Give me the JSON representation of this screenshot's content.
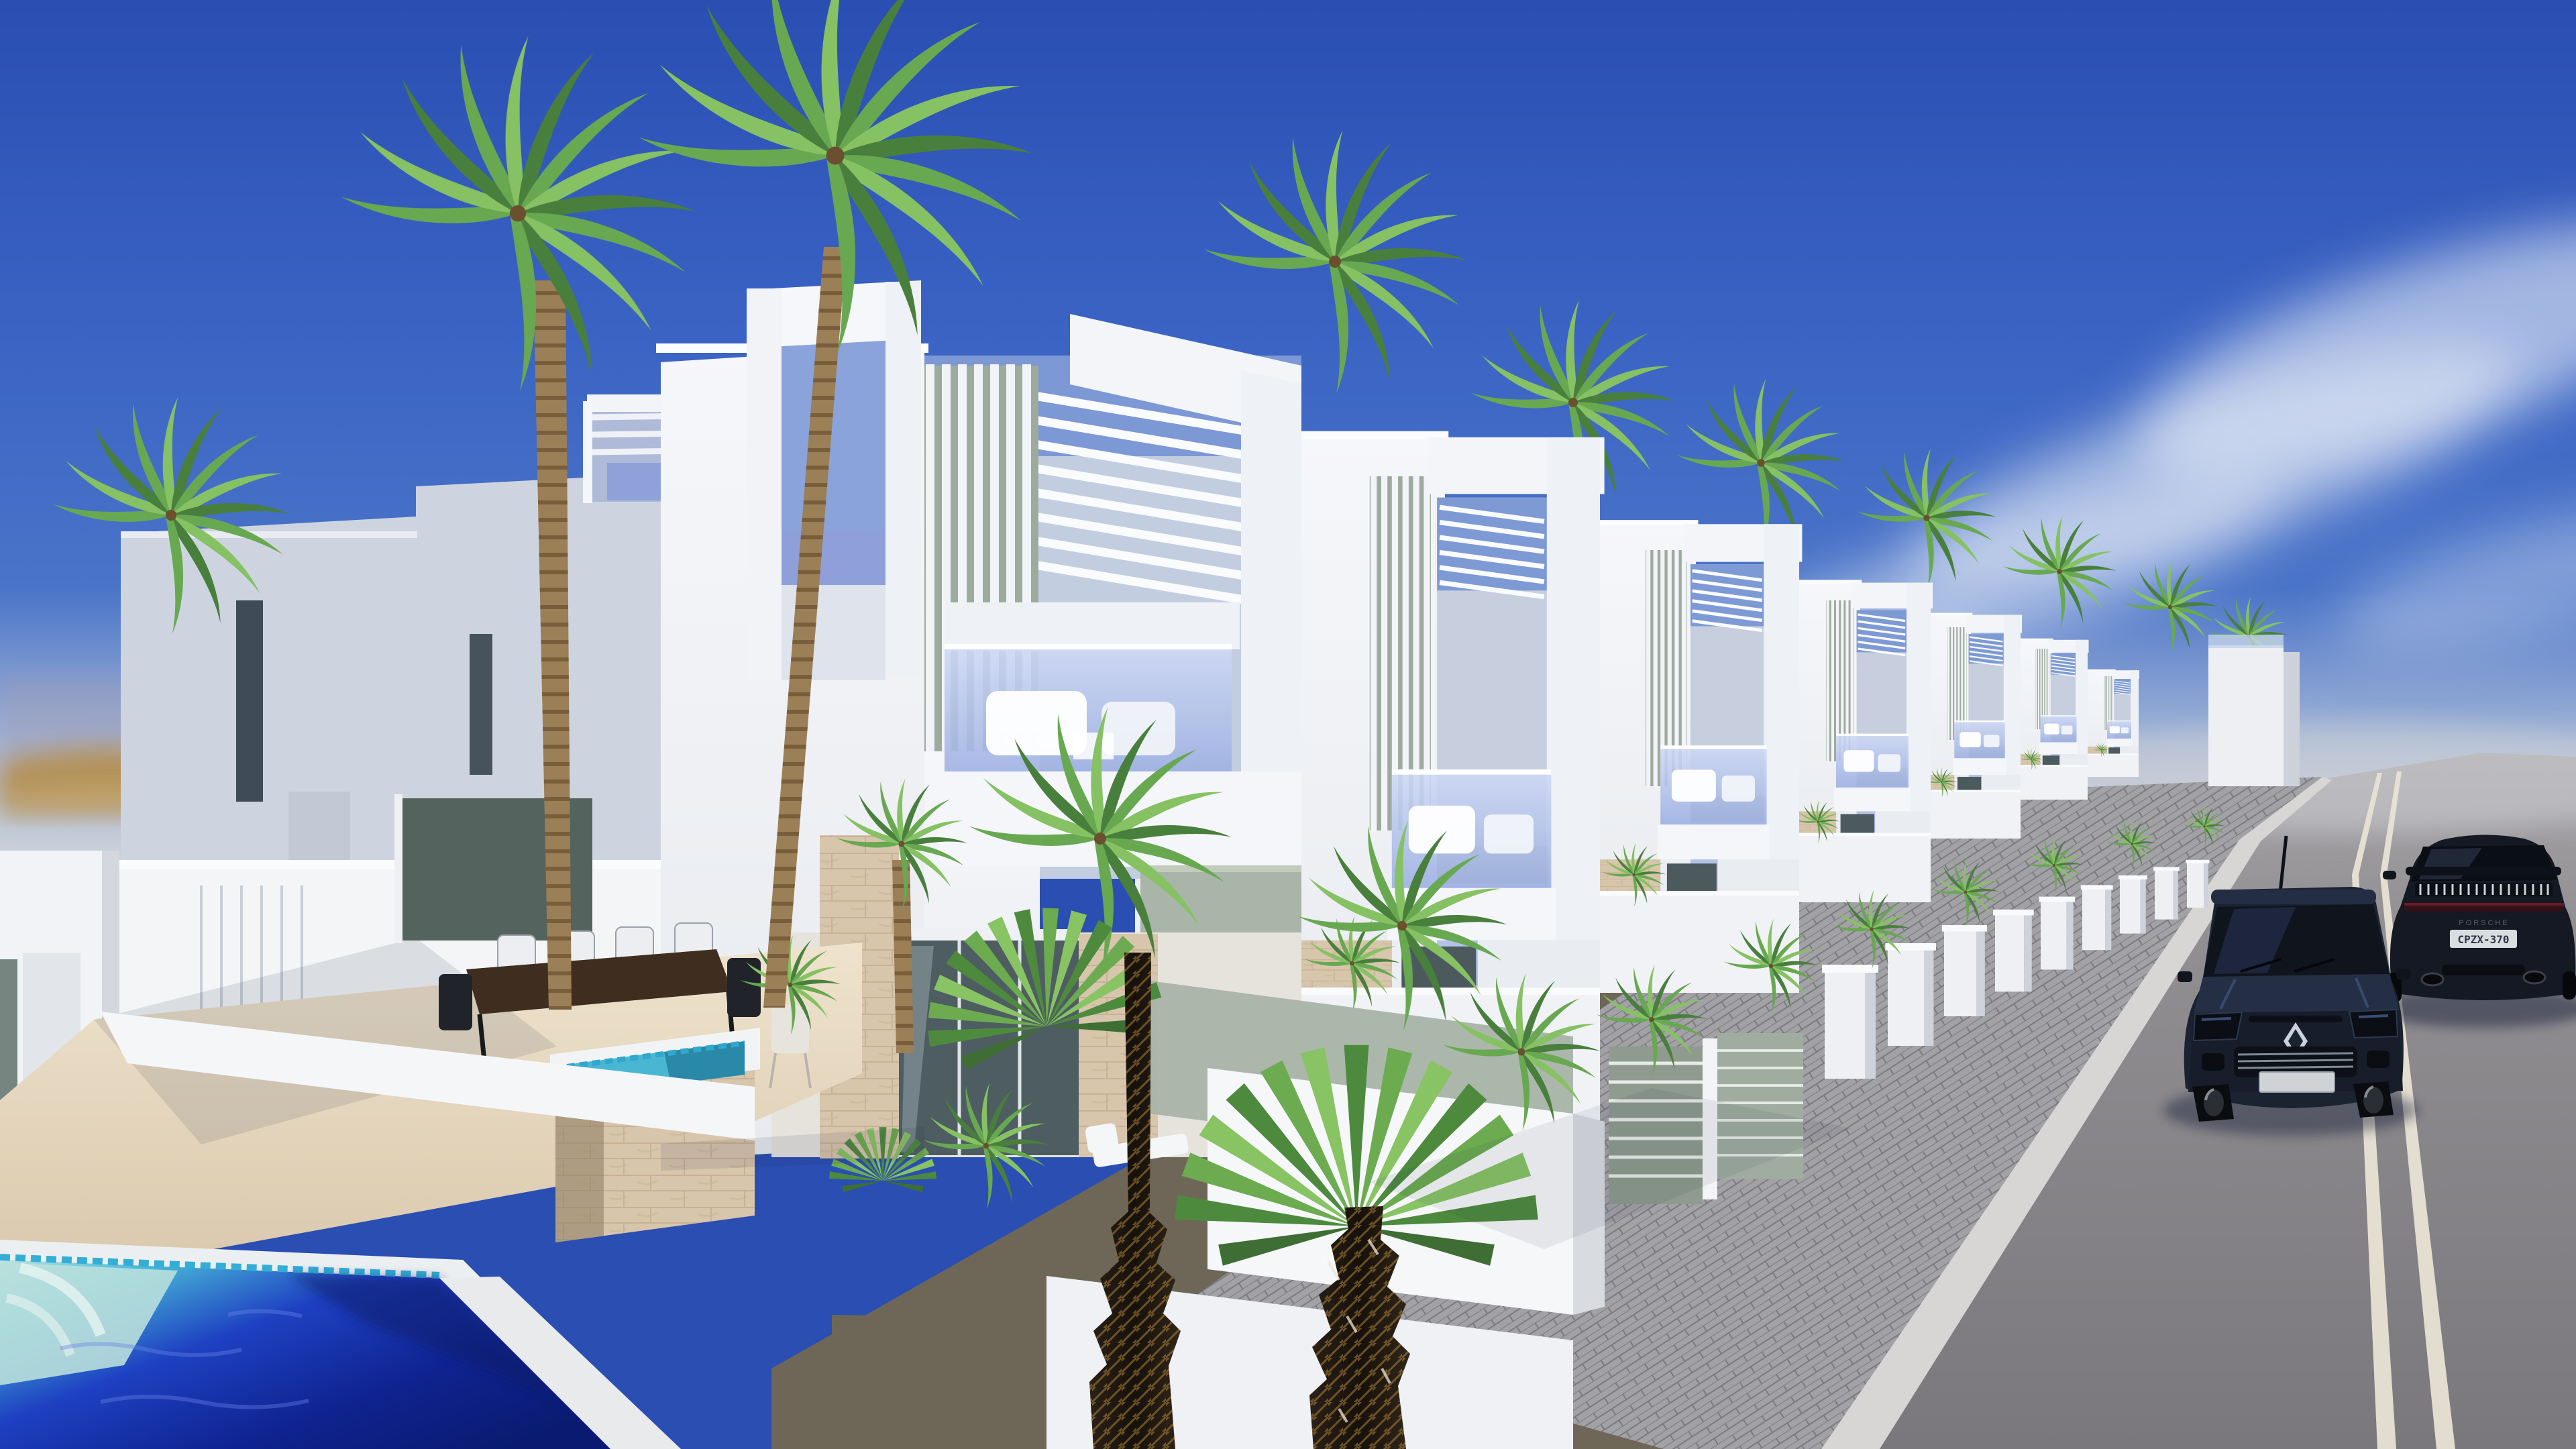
{
  "scene": {
    "type": "3d-architectural-rendering",
    "description": "Street-side view of a row of modern white two-storey villas with rooftop pergola slats, vertical louvers, glass balconies and private pools; tall palm trees, a deep blue swimming pool in the foreground, a paved sidewalk and an asphalt road with a double center line, a dark Renault hatchback and a black Porsche coupe driving uphill under a clear blue sky",
    "time_of_day": "midday",
    "weather": "sunny with thin wispy clouds",
    "setting": "coastal resort development with desert hills on the left horizon"
  },
  "counts": {
    "villas": 10,
    "palm_trees": 14,
    "cars": 2,
    "pools": 3,
    "sun_loungers": 3,
    "dining_chairs": 6
  },
  "road": {
    "surface": "asphalt",
    "marking": "double solid center line",
    "marking_color_name": "off-white",
    "sidewalk": "grey paver bricks with light concrete curb"
  },
  "vehicles": {
    "hatchback": {
      "label": "dark navy Renault hatchback, front view",
      "brand_logo": "renault-diamond-icon"
    },
    "sports_car": {
      "label": "black Porsche 911-style coupe, rear view",
      "badge": "PORSCHE",
      "license_plate": "CPZX-370"
    }
  },
  "landscaping": {
    "palms": "coconut and fan palms",
    "shrubs": "small palm bushes along the sidewalk",
    "ground": "gravel planting beds"
  },
  "furniture": {
    "terrace": "dark wood dining table with six chairs",
    "balconies": "white outdoor sofas with cushions",
    "pool_deck": "white sun loungers",
    "extras": "rooftop outdoor shower, potted plants"
  },
  "colors": {
    "sky_top": "#2a4eb2",
    "sky_mid": "#4a74c8",
    "sky_horizon": "#ccd2d9",
    "cloud": "#e9eef6",
    "haze_left": "#a39bb0",
    "hills": "#b3925a",
    "wall_sunlit": "#f6f7fa",
    "wall_front": "#dce1e9",
    "wall_shadow": "#ced4df",
    "sage_panel": "#a9b5a9",
    "sage_dark": "#76857f",
    "louver_gap": "#9dab9f",
    "stone": "#d7c5ac",
    "stone_joint": "#c0a98d",
    "glass_top": "#cdd8f4",
    "glass_bottom": "#9cafe2",
    "parapet": "#f4f6f9",
    "deck_sun": "#efe3cd",
    "deck_shadow": "#d8c7ac",
    "terrace_glass": "#55635e",
    "table_wood": "#3f2e20",
    "pool_steps": "#bfe6e0",
    "pool_tile": "#35aed6",
    "pool_mid": "#1e41c2",
    "pool_deep": "#0a1a70",
    "plunge_water": "#49b7d2",
    "road_far": "#a7a5a8",
    "road_near": "#7a787c",
    "road_line": "#e9e3d5",
    "sidewalk": "#a2a1a5",
    "paver_joint": "#7b7a7f",
    "curb": "#d7d6d4",
    "gravel": "#6e6757",
    "palm_dark": "#497f3c",
    "palm_mid": "#68a851",
    "palm_light": "#86c163",
    "trunk_ringed": "#9b7f57",
    "trunk_dark": "#16110b",
    "trunk_fiber": "#be8c3c",
    "car_hatch_body": "#1b2331",
    "car_glass": "#10141d",
    "car_sport_body": "#141923",
    "taillight": "#7a1a28",
    "plate": "#d9dde0",
    "shadow": "#0c1530"
  }
}
